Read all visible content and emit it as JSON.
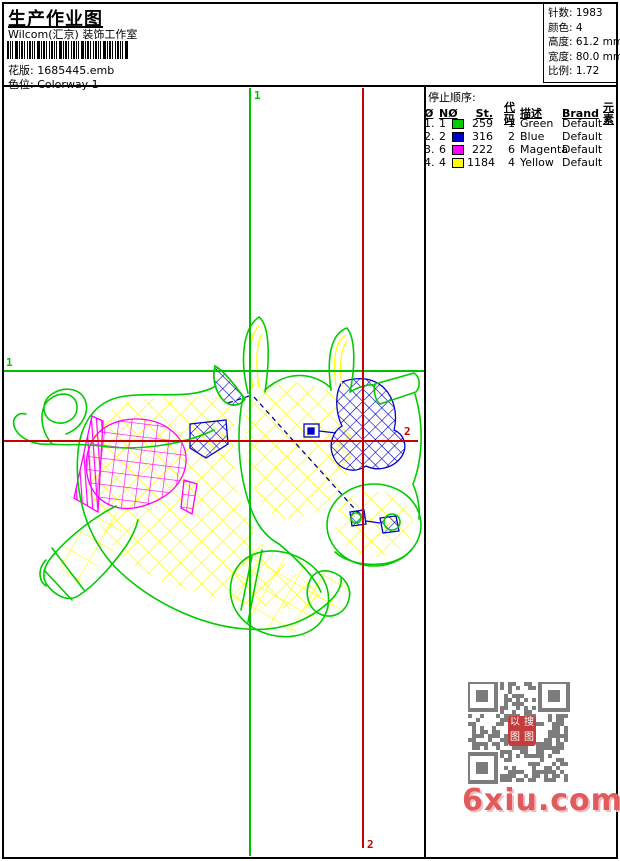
{
  "header": {
    "title": "生产作业图",
    "subtitle": "Wilcom(汇京) 装饰工作室",
    "design_label": "花版:",
    "design_value": "1685445.emb",
    "colorway_label": "色位:",
    "colorway_value": "Colorway 1"
  },
  "stats": [
    {
      "label": "针数:",
      "value": "1983"
    },
    {
      "label": "颜色:",
      "value": "4"
    },
    {
      "label": "高度:",
      "value": "61.2 mm"
    },
    {
      "label": "宽度:",
      "value": "80.0 mm"
    },
    {
      "label": "比例:",
      "value": "1.72"
    }
  ],
  "stop_sequence": {
    "title": "停止顺序:",
    "columns": {
      "stop": "Ø",
      "needle": "NØ",
      "st": "St.",
      "code": "代码",
      "desc": "描述",
      "brand": "Brand",
      "element": "元素"
    },
    "rows": [
      {
        "idx": "1.",
        "needle": "1",
        "swatch": "#00cc00",
        "st": "259",
        "code": "1",
        "desc": "Green",
        "brand": "Default",
        "element": ""
      },
      {
        "idx": "2.",
        "needle": "2",
        "swatch": "#0000cc",
        "st": "316",
        "code": "2",
        "desc": "Blue",
        "brand": "Default",
        "element": ""
      },
      {
        "idx": "3.",
        "needle": "6",
        "swatch": "#ff00ff",
        "st": "222",
        "code": "6",
        "desc": "Magenta",
        "brand": "Default",
        "element": ""
      },
      {
        "idx": "4.",
        "needle": "4",
        "swatch": "#ffff00",
        "st": "1184",
        "code": "4",
        "desc": "Yellow",
        "brand": "Default",
        "element": ""
      }
    ]
  },
  "markers": {
    "start_label": "1",
    "end_label": "2",
    "start_color": "#00c000",
    "end_color": "#c80000"
  },
  "design_colors": {
    "green": "#00cc00",
    "blue": "#0000cc",
    "magenta": "#ff00ff",
    "yellow": "#ffff00",
    "connector": "#000099"
  },
  "watermark": {
    "site": "6xiu.com",
    "site_color": "#e05c5c",
    "seal_chars": [
      "以",
      "搜",
      "图",
      "图"
    ],
    "qr_color": "#7d7d7d"
  }
}
